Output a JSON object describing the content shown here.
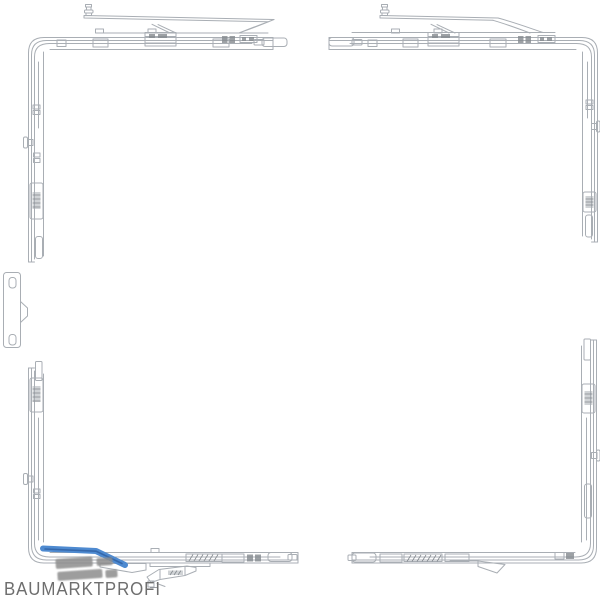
{
  "colors": {
    "background": "#ffffff",
    "line": "#a9aeb4",
    "line_dark": "#84898f",
    "highlight_blue": "#4e8ad0",
    "highlight_blue_dark": "#3568ab",
    "watermark_gray": "#8d8d8d",
    "brand_gray": "#6e6e6e"
  },
  "watermark": {
    "brand": "BAUMARKTPROFI"
  },
  "parts": [
    "corner-assembly-top-left",
    "corner-assembly-top-right",
    "corner-assembly-bottom-left",
    "corner-assembly-bottom-right",
    "strike-plate-left",
    "loose-part-bottom",
    "highlight-strip"
  ]
}
